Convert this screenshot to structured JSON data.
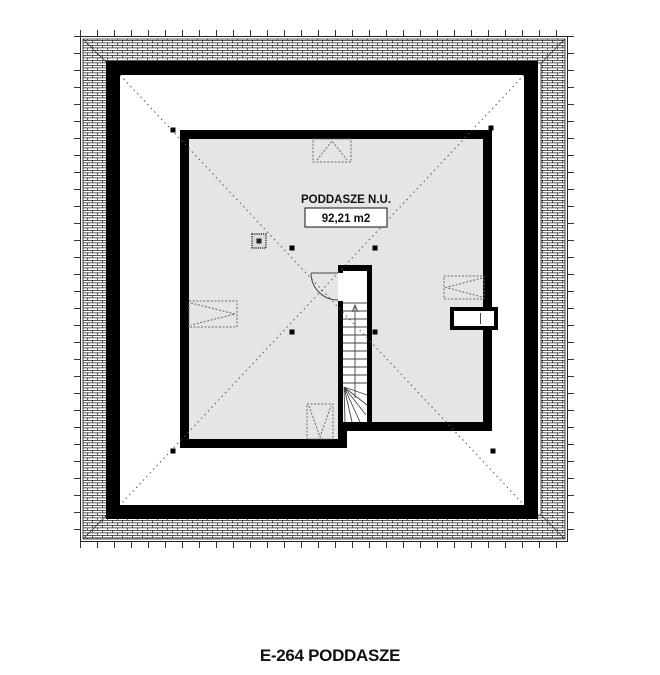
{
  "drawing": {
    "caption": "E-264 PODDASZE",
    "room": {
      "label": "PODDASZE N.U.",
      "area": "92,21 m2"
    },
    "symbols": {
      "roof_windows": [
        "top",
        "left",
        "bottom",
        "right"
      ],
      "chimney": "chimney-flue-symbol",
      "stairs": "winder-staircase",
      "door": "door-swing-quarter-arc",
      "wall_niche": "right-wall-niche",
      "ridge_markers_count": 8
    },
    "colors": {
      "background": "#ffffff",
      "wall": "#000000",
      "room_fill": "#e5e5e5",
      "ridge_line": "#555555",
      "hatch_line": "#222222"
    }
  }
}
